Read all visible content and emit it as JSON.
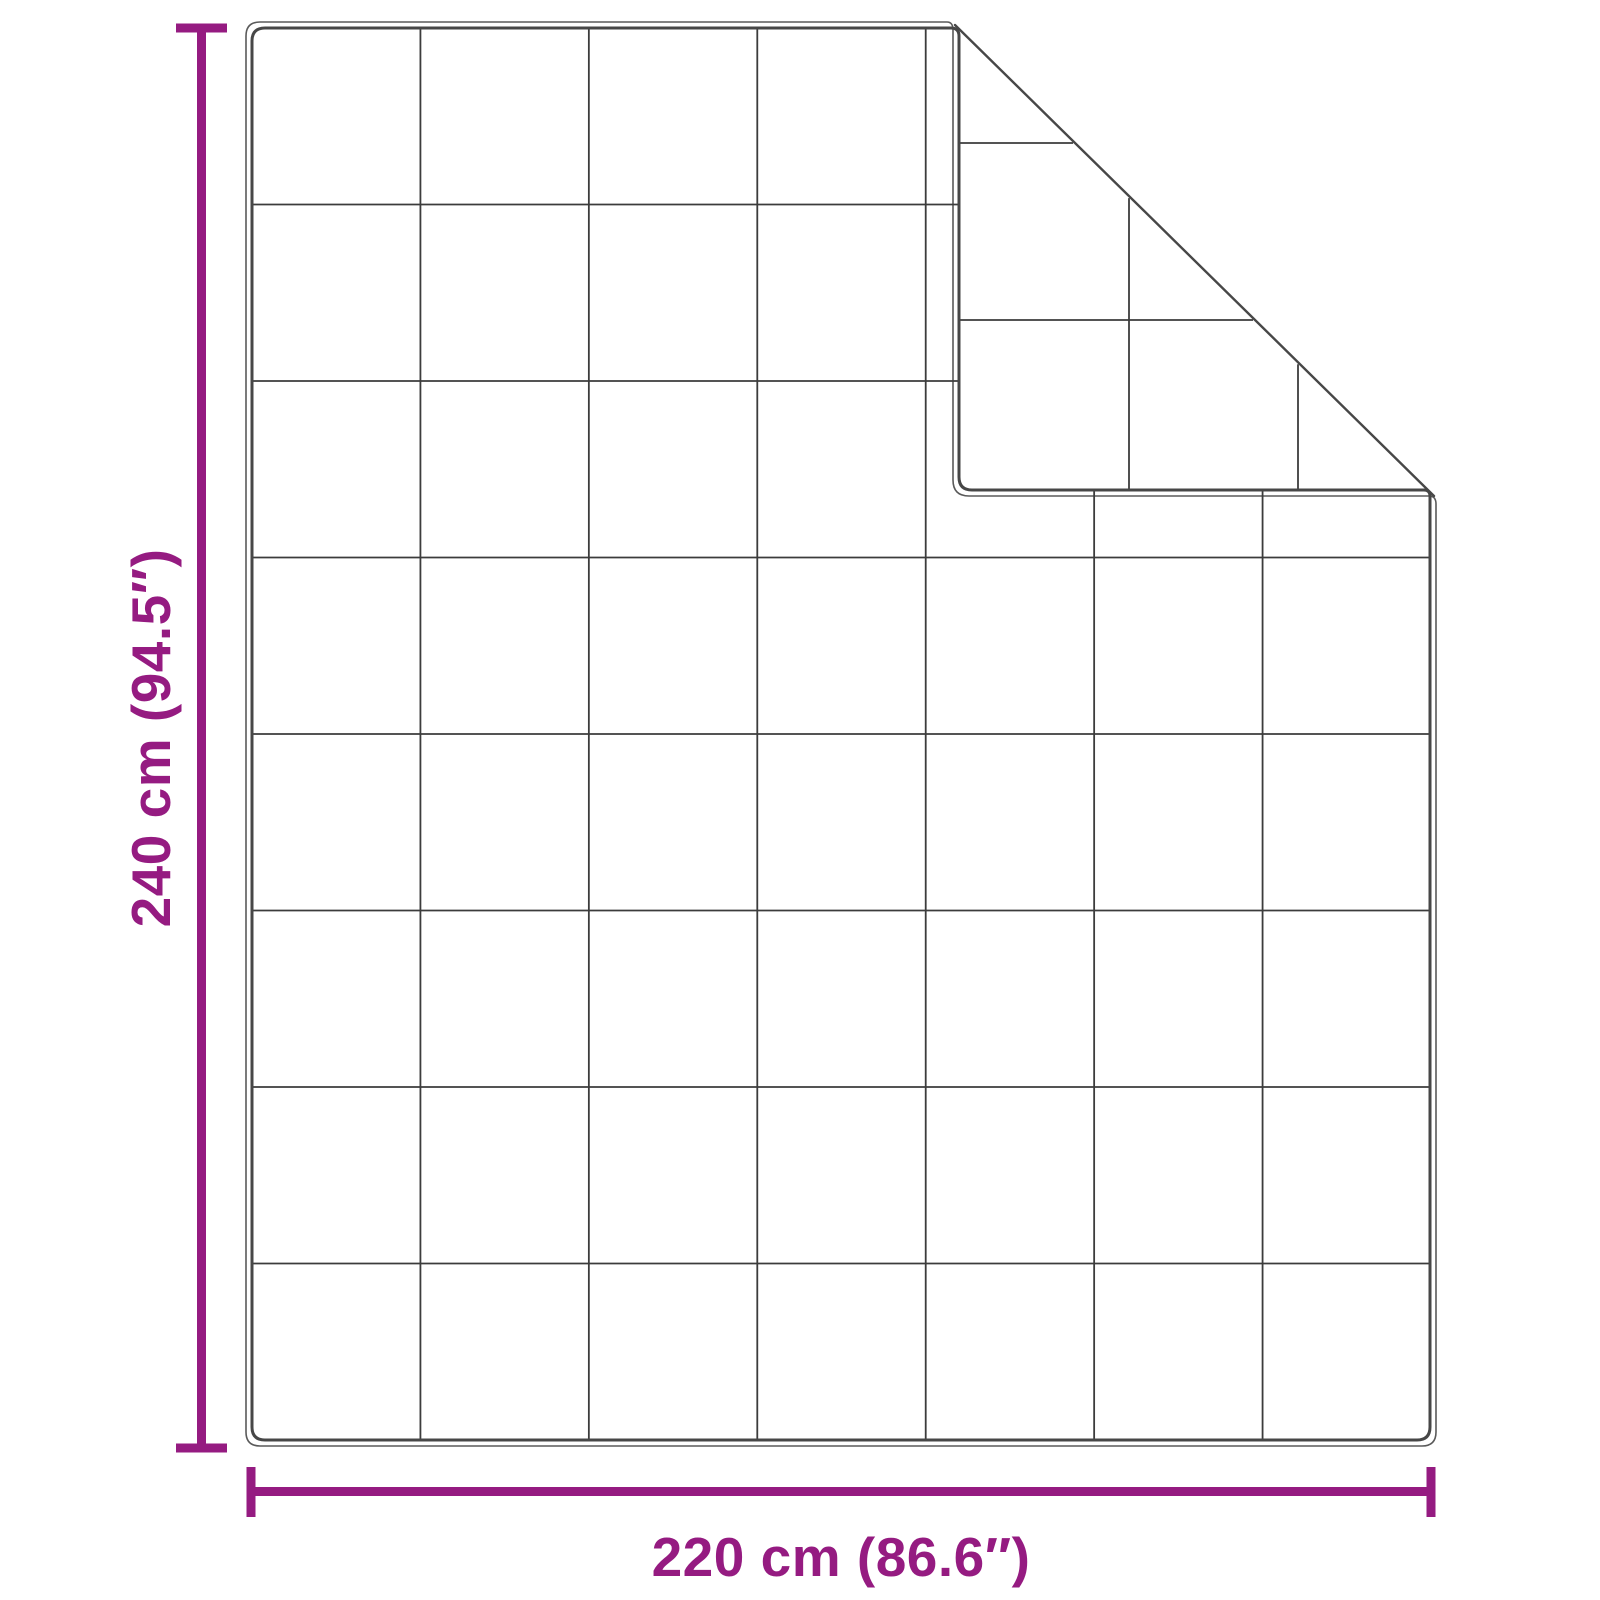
{
  "labels": {
    "height": "240 cm (94.5″)",
    "width": "220 cm (86.6″)"
  },
  "colors": {
    "dimension_accent": "#951B81",
    "blanket_edge": "#474747",
    "fabric_outline": "#5A5A5A",
    "quilt_grid": "#3C3C3C",
    "background": "#FFFFFF"
  },
  "blanket": {
    "front_grid_columns": 7,
    "front_grid_rows": 8,
    "back_flap_horizontal_quilt_y": [
      143,
      320
    ],
    "back_flap_vertical_quilt_x": [
      1129,
      1298
    ]
  }
}
